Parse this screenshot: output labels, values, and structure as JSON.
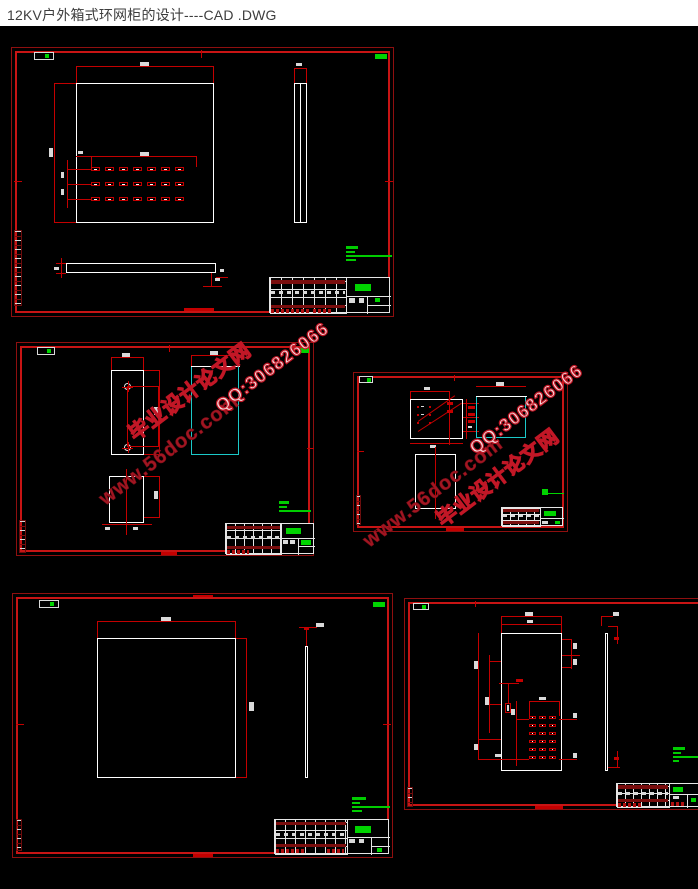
{
  "header": {
    "title": "12KV户外箱式环网柜的设计----CAD .DWG"
  },
  "watermark": {
    "site": "www.56doc.com",
    "brand": "毕业设计论文网",
    "qq": "QQ:306826066"
  },
  "colors": {
    "canvas": "#000000",
    "titlebar_bg": "#ffffff",
    "titlebar_text": "#3d3d3d",
    "frame_red": "#c81414",
    "dim_red": "#c40000",
    "line_white": "#ffffff",
    "accent_cyan": "#1bc9c9",
    "annotation_green": "#00d400",
    "watermark_solid": "#a31622",
    "watermark_outline": "#c21726"
  }
}
